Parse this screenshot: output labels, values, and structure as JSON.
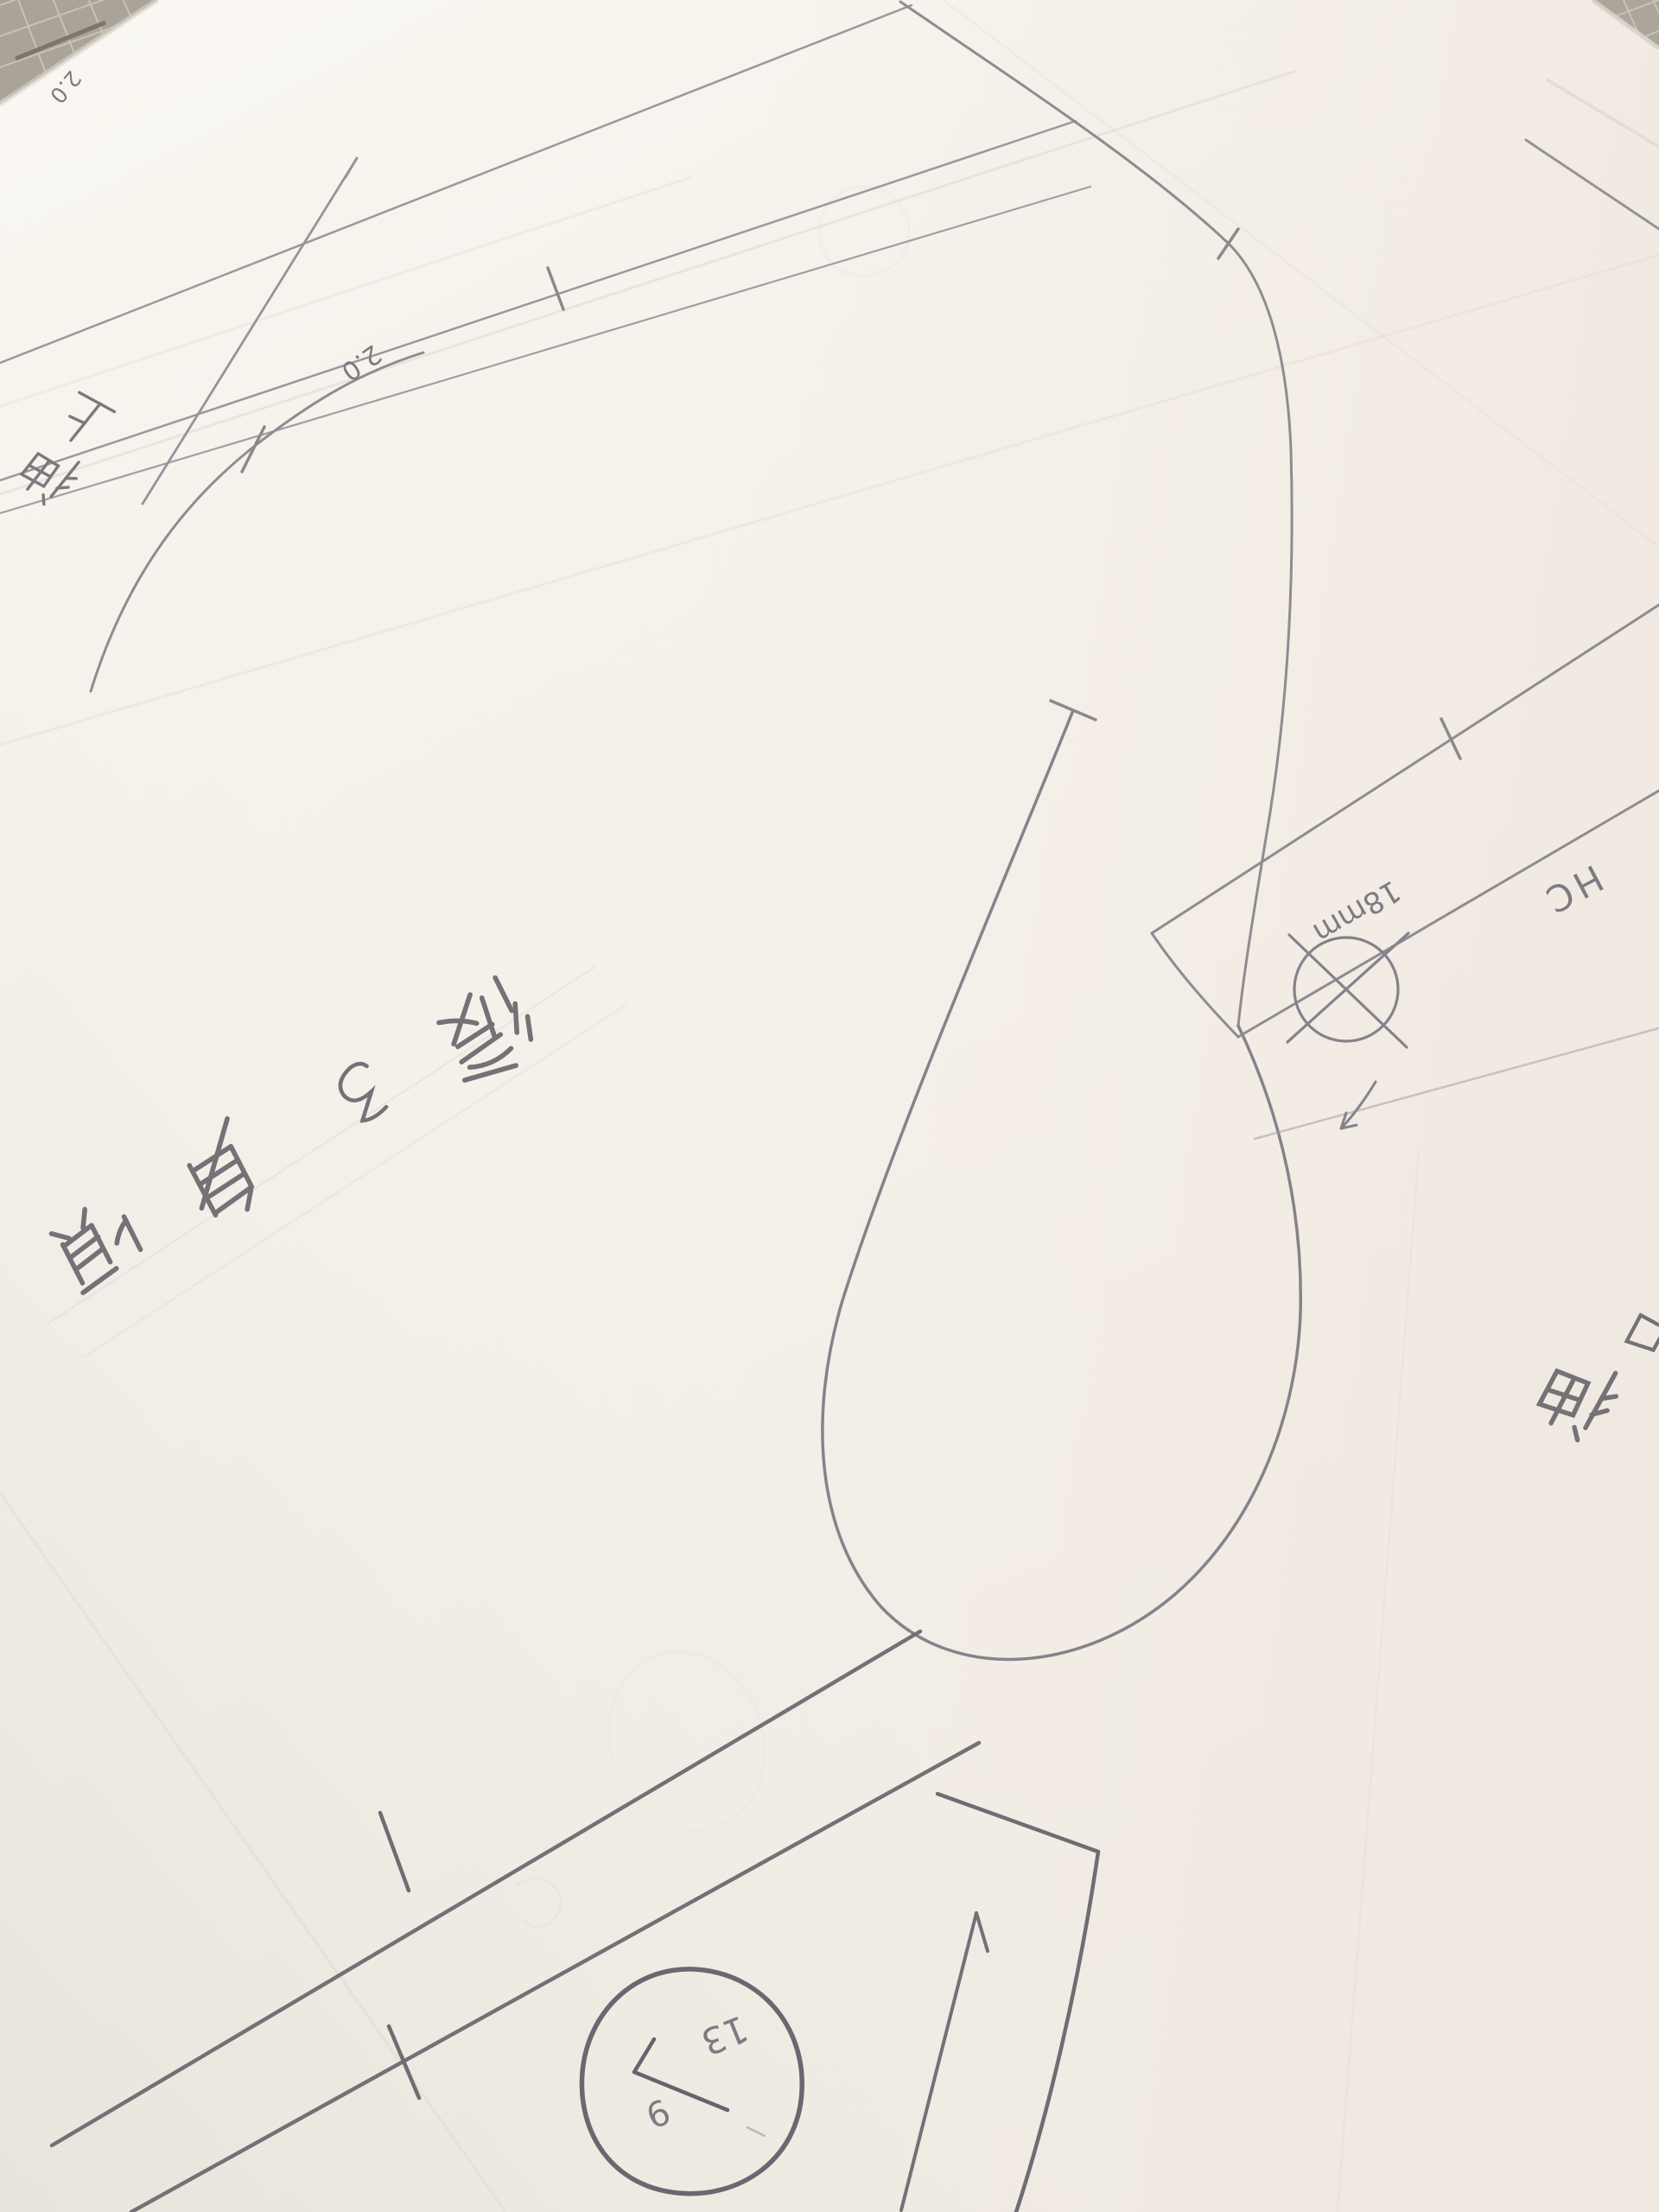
{
  "scene": {
    "type": "photograph",
    "subject": "Hand-drawn sewing pattern pieces in pencil on white pattern paper, photographed at an angle on a cutting mat",
    "paper_color": "#f4f1ea",
    "pencil_color": "#85838a",
    "mat_color": "#a9a497"
  },
  "annotations": {
    "mat_corner_measurement": "2.0",
    "sleeve_cap_measurement": "2.0",
    "upper_sleeve_label": "上袖",
    "back_bodice_label": "後ろ身頃",
    "button_size_note": "18mm",
    "band_label": "HC",
    "cuff_opening_label": "袖口",
    "circled_note": "13/9",
    "circled_note_numerator": "13",
    "circled_note_denominator": "9"
  },
  "symbols": {
    "button_placement_icon": "hand-drawn circle crossed by two diagonal lines (button mark)",
    "grainline_icon": "pencil line with arrowhead",
    "notch_icon": "short tick mark crossing a seam line",
    "circled_number_icon": "hand-drawn circle around fraction 13/9"
  }
}
